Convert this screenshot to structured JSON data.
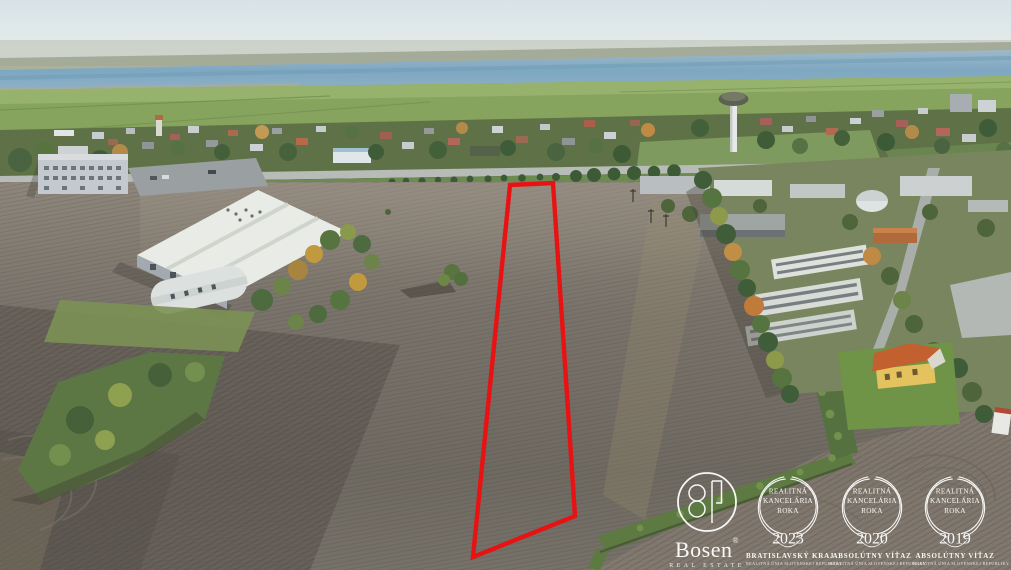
{
  "image": {
    "type": "aerial-drone-photograph",
    "subject": "Land plot for sale outlined in red, plowed fields at the edge of a town with warehouse, industrial zone, water tower and lake on the horizon",
    "season": "autumn"
  },
  "palette": {
    "plot_outline_red": "#e81212",
    "sky": "#dde7e9",
    "water": "#82a9c2",
    "far_fields": "#86a35f",
    "town_band": "#5f7247",
    "field": "#7b746b",
    "field_dark": "#5b554e",
    "road": "#b7bcb8",
    "warehouse_roof": "#e9ebe7",
    "lawn": "#6f9448",
    "house_roof_orange": "#c2602f",
    "house_wall_yellow": "#e4c35f",
    "watermark_white": "#ffffff"
  },
  "watermark": {
    "logo": {
      "brand": "Bosen",
      "registered": "®",
      "subtitle": "REAL ESTATE"
    },
    "awards": [
      {
        "title_line1": "REALITNÁ",
        "title_line2": "KANCELÁRIA",
        "title_line3": "ROKA",
        "year": "2023",
        "winner_label": "BRATISLAVSKÝ KRAJ",
        "org_label": "REALITNÁ ÚNIA SLOVENSKEJ REPUBLIKY"
      },
      {
        "title_line1": "REALITNÁ",
        "title_line2": "KANCELÁRIA",
        "title_line3": "ROKA",
        "year": "2020",
        "winner_label": "ABSOLÚTNY VÍŤAZ",
        "org_label": "REALITNÁ ÚNIA SLOVENSKEJ REPUBLIKY"
      },
      {
        "title_line1": "REALITNÁ",
        "title_line2": "KANCELÁRIA",
        "title_line3": "ROKA",
        "year": "2019",
        "winner_label": "ABSOLÚTNY VÍŤAZ",
        "org_label": "REALITNÁ ÚNIA SLOVENSKEJ REPUBLIKY"
      }
    ]
  }
}
